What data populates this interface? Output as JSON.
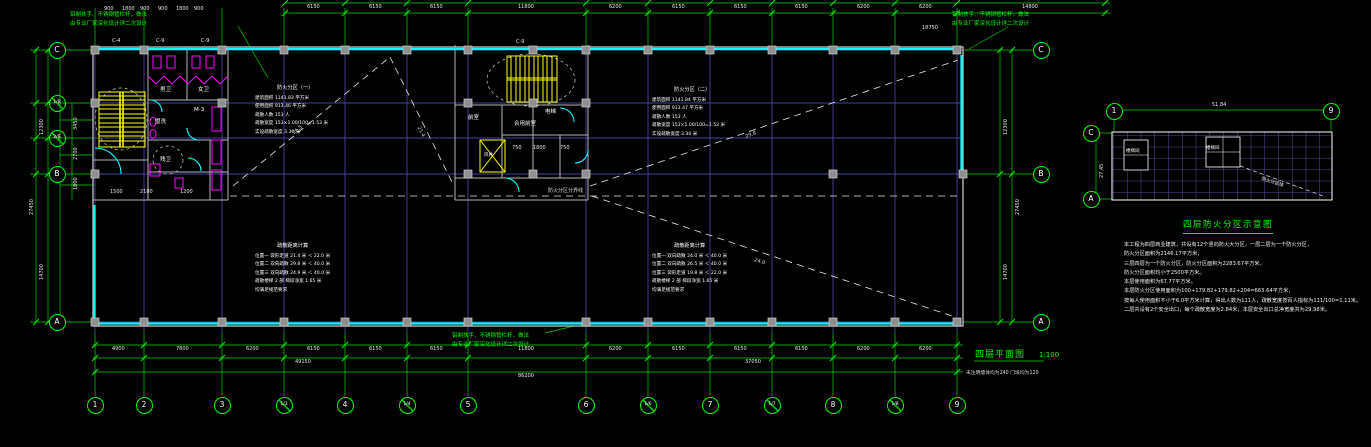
{
  "colors": {
    "background": "#000000",
    "axis_grid": "#4242a0",
    "accent_green": "#00ff00",
    "glazing_cyan": "#00ffff",
    "stair_yellow": "#ffff00",
    "fixture_magenta": "#ff00ff",
    "wall_gray": "#b4b4b4",
    "keyplan_grid": "#6060c8"
  },
  "drawing": {
    "main_title": {
      "text": "四层平面图",
      "scale": "1:100",
      "note": "未注明墙体均为240  门垛均为120"
    },
    "leader": {
      "line1": "铝制扶手、不锈钢管栏杆，做法",
      "line2": "由专业厂家深化设计详二次设计"
    },
    "key_plan": {
      "title": "四层防火分区示意图",
      "bubbles": [
        {
          "t": "1",
          "x": 1114,
          "y": 111,
          "c": "bubble"
        },
        {
          "t": "9",
          "x": 1331,
          "y": 111,
          "c": "bubble"
        },
        {
          "t": "C",
          "x": 1091,
          "y": 133,
          "c": "bubble"
        },
        {
          "t": "A",
          "x": 1091,
          "y": 199,
          "c": "bubble"
        }
      ],
      "labels": [
        {
          "t": "51.84",
          "x": 1212,
          "y": 103,
          "c": "dim"
        },
        {
          "t": "27.45",
          "x": 1100,
          "y": 178,
          "r": -90,
          "c": "dim"
        },
        {
          "t": "楼梯间",
          "x": 1126,
          "y": 150,
          "c": "kpl"
        },
        {
          "t": "楼梯间",
          "x": 1206,
          "y": 147,
          "c": "kpl"
        },
        {
          "t": "防火分区线",
          "x": 1262,
          "y": 178,
          "r": 17,
          "c": "kpl"
        }
      ]
    },
    "notes": {
      "lines": [
        "本工程为四层商业建筑，共设有12个竖向防火大分区，一层二层为一个防火分区，",
        "防火分区面积为2146.17平方米，",
        "三层四层为一个防火分区，防火分区面积为2283.67平方米，",
        "防火分区面积均小于2500平方米。",
        "本层使用面积为67.77平方米。",
        "本层防火分区使用面积为100+179.82+179.82+204=663.64平方米，",
        "按每人使用面积不小于6.0平方米计算，得出人数为111人，疏散宽度按百人指标为111/100=1.11米。",
        "二层共设有2个安全出口，每个疏散宽度为2.84米，本层安全出口总净宽度共为29.98米。"
      ]
    },
    "axes": {
      "bottom": [
        {
          "t": "1",
          "x": 95,
          "y": 405,
          "c": "bubble"
        },
        {
          "t": "2",
          "x": 144,
          "y": 405,
          "c": "bubble"
        },
        {
          "t": "3",
          "x": 222,
          "y": 405,
          "c": "bubble"
        },
        {
          "t": "1/3",
          "x": 284,
          "y": 405,
          "c": "bubble slash"
        },
        {
          "t": "4",
          "x": 345,
          "y": 405,
          "c": "bubble"
        },
        {
          "t": "1/4",
          "x": 407,
          "y": 405,
          "c": "bubble slash"
        },
        {
          "t": "5",
          "x": 468,
          "y": 405,
          "c": "bubble"
        },
        {
          "t": "6",
          "x": 586,
          "y": 405,
          "c": "bubble"
        },
        {
          "t": "1/6",
          "x": 648,
          "y": 405,
          "c": "bubble slash"
        },
        {
          "t": "7",
          "x": 710,
          "y": 405,
          "c": "bubble"
        },
        {
          "t": "1/7",
          "x": 772,
          "y": 405,
          "c": "bubble slash"
        },
        {
          "t": "8",
          "x": 833,
          "y": 405,
          "c": "bubble"
        },
        {
          "t": "1/8",
          "x": 895,
          "y": 405,
          "c": "bubble slash"
        },
        {
          "t": "9",
          "x": 957,
          "y": 405,
          "c": "bubble"
        }
      ],
      "left": [
        {
          "t": "C",
          "x": 57,
          "y": 50,
          "c": "bubble"
        },
        {
          "t": "1/B",
          "x": 57,
          "y": 103,
          "c": "bubble slash"
        },
        {
          "t": "2/B",
          "x": 57,
          "y": 138,
          "c": "bubble slash"
        },
        {
          "t": "B",
          "x": 57,
          "y": 174,
          "c": "bubble"
        },
        {
          "t": "A",
          "x": 57,
          "y": 322,
          "c": "bubble"
        }
      ],
      "right": [
        {
          "t": "C",
          "x": 1041,
          "y": 50,
          "c": "bubble"
        },
        {
          "t": "B",
          "x": 1041,
          "y": 174,
          "c": "bubble"
        },
        {
          "t": "A",
          "x": 1041,
          "y": 322,
          "c": "bubble"
        }
      ]
    },
    "dimensions": {
      "pins": [
        {
          "t": "4900",
          "x": 112,
          "y": 347,
          "c": "dim"
        },
        {
          "t": "7800",
          "x": 176,
          "y": 347,
          "c": "dim"
        },
        {
          "t": "6200",
          "x": 246,
          "y": 347,
          "c": "dim"
        },
        {
          "t": "6150",
          "x": 307,
          "y": 347,
          "c": "dim"
        },
        {
          "t": "6150",
          "x": 369,
          "y": 347,
          "c": "dim"
        },
        {
          "t": "6150",
          "x": 430,
          "y": 347,
          "c": "dim"
        },
        {
          "t": "11800",
          "x": 518,
          "y": 347,
          "c": "dim"
        },
        {
          "t": "6200",
          "x": 609,
          "y": 347,
          "c": "dim"
        },
        {
          "t": "6150",
          "x": 672,
          "y": 347,
          "c": "dim"
        },
        {
          "t": "6150",
          "x": 734,
          "y": 347,
          "c": "dim"
        },
        {
          "t": "6150",
          "x": 795,
          "y": 347,
          "c": "dim"
        },
        {
          "t": "6200",
          "x": 857,
          "y": 347,
          "c": "dim"
        },
        {
          "t": "6200",
          "x": 919,
          "y": 347,
          "c": "dim"
        },
        {
          "t": "49150",
          "x": 295,
          "y": 360,
          "c": "dim"
        },
        {
          "t": "37050",
          "x": 745,
          "y": 360,
          "c": "dim"
        },
        {
          "t": "86200",
          "x": 518,
          "y": 374,
          "c": "dim"
        },
        {
          "t": "6150",
          "x": 307,
          "y": 5,
          "c": "dim"
        },
        {
          "t": "6150",
          "x": 369,
          "y": 5,
          "c": "dim"
        },
        {
          "t": "6150",
          "x": 430,
          "y": 5,
          "c": "dim"
        },
        {
          "t": "11800",
          "x": 518,
          "y": 5,
          "c": "dim"
        },
        {
          "t": "6200",
          "x": 609,
          "y": 5,
          "c": "dim"
        },
        {
          "t": "6150",
          "x": 672,
          "y": 5,
          "c": "dim"
        },
        {
          "t": "6150",
          "x": 734,
          "y": 5,
          "c": "dim"
        },
        {
          "t": "6150",
          "x": 795,
          "y": 5,
          "c": "dim"
        },
        {
          "t": "6200",
          "x": 857,
          "y": 5,
          "c": "dim"
        },
        {
          "t": "6200",
          "x": 919,
          "y": 5,
          "c": "dim"
        },
        {
          "t": "14800",
          "x": 1022,
          "y": 5,
          "c": "dim"
        },
        {
          "t": "18750",
          "x": 922,
          "y": 26,
          "c": "dim"
        },
        {
          "t": "900",
          "x": 104,
          "y": 7,
          "c": "dim"
        },
        {
          "t": "1800",
          "x": 122,
          "y": 7,
          "c": "dim"
        },
        {
          "t": "900",
          "x": 140,
          "y": 7,
          "c": "dim"
        },
        {
          "t": "900",
          "x": 158,
          "y": 7,
          "c": "dim"
        },
        {
          "t": "1800",
          "x": 176,
          "y": 7,
          "c": "dim"
        },
        {
          "t": "900",
          "x": 194,
          "y": 7,
          "c": "dim"
        },
        {
          "t": "12300",
          "x": 40,
          "y": 135,
          "r": -90,
          "c": "dim"
        },
        {
          "t": "14700",
          "x": 40,
          "y": 280,
          "r": -90,
          "c": "dim"
        },
        {
          "t": "27450",
          "x": 30,
          "y": 215,
          "r": -90,
          "c": "dim"
        },
        {
          "t": "3450",
          "x": 74,
          "y": 130,
          "r": -90,
          "c": "dim"
        },
        {
          "t": "2700",
          "x": 74,
          "y": 160,
          "r": -90,
          "c": "dim"
        },
        {
          "t": "1800",
          "x": 74,
          "y": 190,
          "r": -90,
          "c": "dim"
        },
        {
          "t": "12300",
          "x": 1004,
          "y": 135,
          "r": -90,
          "c": "dim"
        },
        {
          "t": "14700",
          "x": 1004,
          "y": 280,
          "r": -90,
          "c": "dim"
        },
        {
          "t": "27450",
          "x": 1016,
          "y": 215,
          "r": -90,
          "c": "dim"
        },
        {
          "t": "1500",
          "x": 110,
          "y": 190,
          "c": "dim"
        },
        {
          "t": "2100",
          "x": 140,
          "y": 190,
          "c": "dim"
        },
        {
          "t": "1200",
          "x": 180,
          "y": 190,
          "c": "dim"
        },
        {
          "t": "750",
          "x": 512,
          "y": 146,
          "c": "dim"
        },
        {
          "t": "1800",
          "x": 533,
          "y": 146,
          "c": "dim"
        },
        {
          "t": "750",
          "x": 560,
          "y": 146,
          "c": "dim"
        }
      ]
    },
    "window_labels": [
      {
        "t": "C-4",
        "x": 112,
        "y": 39,
        "c": "dim"
      },
      {
        "t": "C-9",
        "x": 156,
        "y": 39,
        "c": "dim"
      },
      {
        "t": "C-9",
        "x": 201,
        "y": 39,
        "c": "dim"
      },
      {
        "t": "C-9",
        "x": 516,
        "y": 40,
        "c": "dim"
      }
    ],
    "room_labels": [
      {
        "t": "男卫",
        "x": 160,
        "y": 88,
        "c": "rm"
      },
      {
        "t": "女卫",
        "x": 198,
        "y": 88,
        "c": "rm"
      },
      {
        "t": "盥洗",
        "x": 155,
        "y": 120,
        "c": "rm"
      },
      {
        "t": "M-3",
        "x": 194,
        "y": 108,
        "c": "rm"
      },
      {
        "t": "残卫",
        "x": 160,
        "y": 158,
        "c": "rm"
      },
      {
        "t": "前室",
        "x": 468,
        "y": 116,
        "c": "rm"
      },
      {
        "t": "合用前室",
        "x": 514,
        "y": 122,
        "c": "rm"
      },
      {
        "t": "电梯",
        "x": 545,
        "y": 110,
        "c": "rm"
      },
      {
        "t": "风井",
        "x": 484,
        "y": 154,
        "c": "kpl"
      }
    ],
    "evac_labels": [
      {
        "t": "26.5",
        "x": 292,
        "y": 132,
        "r": -39,
        "c": "evac"
      },
      {
        "t": "21.4",
        "x": 420,
        "y": 126,
        "r": 62,
        "c": "evac"
      },
      {
        "t": "29.8",
        "x": 745,
        "y": 135,
        "r": -19,
        "c": "evac"
      },
      {
        "t": "24.0",
        "x": 755,
        "y": 258,
        "r": 19,
        "c": "evac"
      },
      {
        "t": "防火分区分界线",
        "x": 548,
        "y": 189,
        "c": "evac"
      }
    ],
    "spec_blocks": [
      {
        "heading": "防火分区（一）",
        "lines": [
          "建筑面积     1141.83 平方米",
          "使用面积      913.46 平方米",
          "疏散人数      153 人",
          "疏散宽度  153×1.00/100=1.53 米",
          "实设疏散宽度  3.30 米"
        ]
      },
      {
        "heading": "防火分区（二）",
        "lines": [
          "建筑面积     1141.84 平方米",
          "使用面积      913.47 平方米",
          "疏散人数      153 人",
          "疏散宽度  153×1.00/100=1.53 米",
          "实设疏散宽度  3.30 米"
        ]
      },
      {
        "heading": "疏散距离计算",
        "lines": [
          "位置一  袋形走道  21.4 米 ＜ 22.0 米",
          "位置二  双向疏散  29.8 米 ＜ 40.0 米",
          "位置三  双向疏散  24.9 米 ＜ 40.0 米",
          "疏散楼梯 2 部  梯段净宽 1.65 米",
          "均满足规范要求"
        ]
      },
      {
        "heading": "疏散距离计算",
        "lines": [
          "位置一  双向疏散  24.0 米 ＜ 40.0 米",
          "位置二  双向疏散  26.5 米 ＜ 40.0 米",
          "位置三  袋形走道  19.8 米 ＜ 22.0 米",
          "疏散楼梯 2 部  梯段净宽 1.65 米",
          "均满足规范要求"
        ]
      }
    ]
  }
}
